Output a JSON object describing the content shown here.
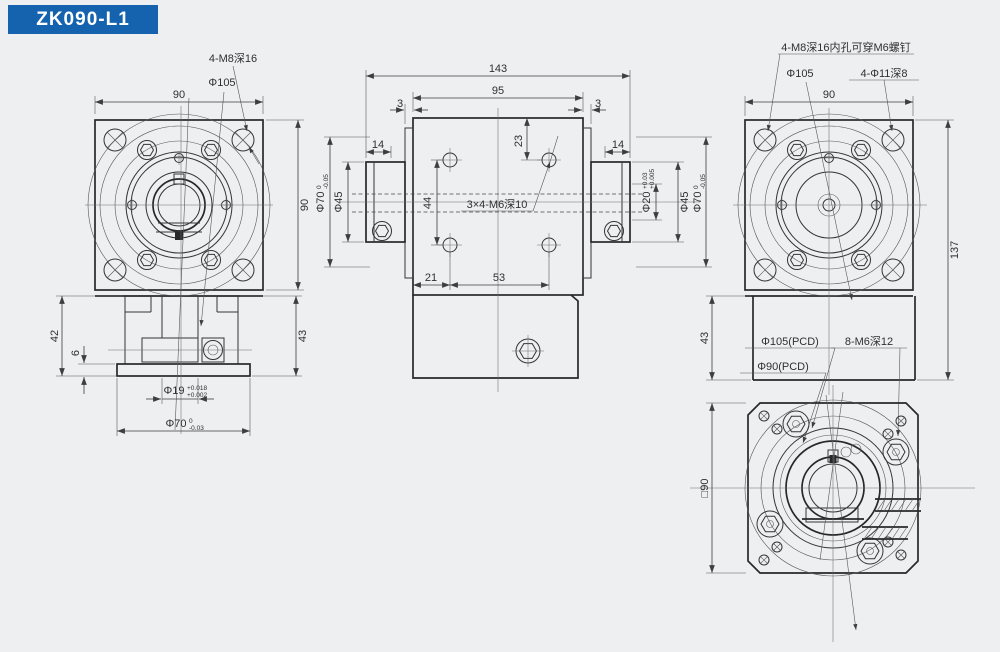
{
  "title": "ZK090-L1",
  "colors": {
    "accent": "#1563ae",
    "background": "#edeff1",
    "line": "#26282a"
  },
  "views": {
    "front": {
      "phi105": "Φ105",
      "m8note": "4-M8深16",
      "d90w": "90",
      "d90h": "90",
      "d42": "42",
      "d6": "6",
      "d43": "43",
      "phi19": {
        "v": "Φ19",
        "up": "+0.018",
        "dn": "+0.002"
      },
      "phi70": {
        "v": "Φ70",
        "up": "0",
        "dn": "-0.03"
      }
    },
    "side": {
      "d143": "143",
      "d95": "95",
      "d3l": "3",
      "d3r": "3",
      "d14l": "14",
      "d14r": "14",
      "d23": "23",
      "d44": "44",
      "d21": "21",
      "d53": "53",
      "m6note": "3×4-M6深10",
      "phi45l": "Φ45",
      "phi45r": "Φ45",
      "phi20": {
        "v": "Φ20",
        "up": "+0.03",
        "dn": "+0.005"
      },
      "phi70l": {
        "v": "Φ70",
        "up": "0",
        "dn": "-0.05"
      },
      "phi70r": {
        "v": "Φ70",
        "up": "0",
        "dn": "-0.05"
      }
    },
    "back": {
      "note": "4-M8深16内孔可穿M6螺钉",
      "phi105": "Φ105",
      "phi11": "4-Φ11深8",
      "d90": "90",
      "d137": "137",
      "d43": "43",
      "pcd105": "Φ105(PCD)",
      "pcd90": "Φ90(PCD)",
      "m6note": "8-M6深12"
    },
    "bottom": {
      "sq90": "□90"
    }
  }
}
